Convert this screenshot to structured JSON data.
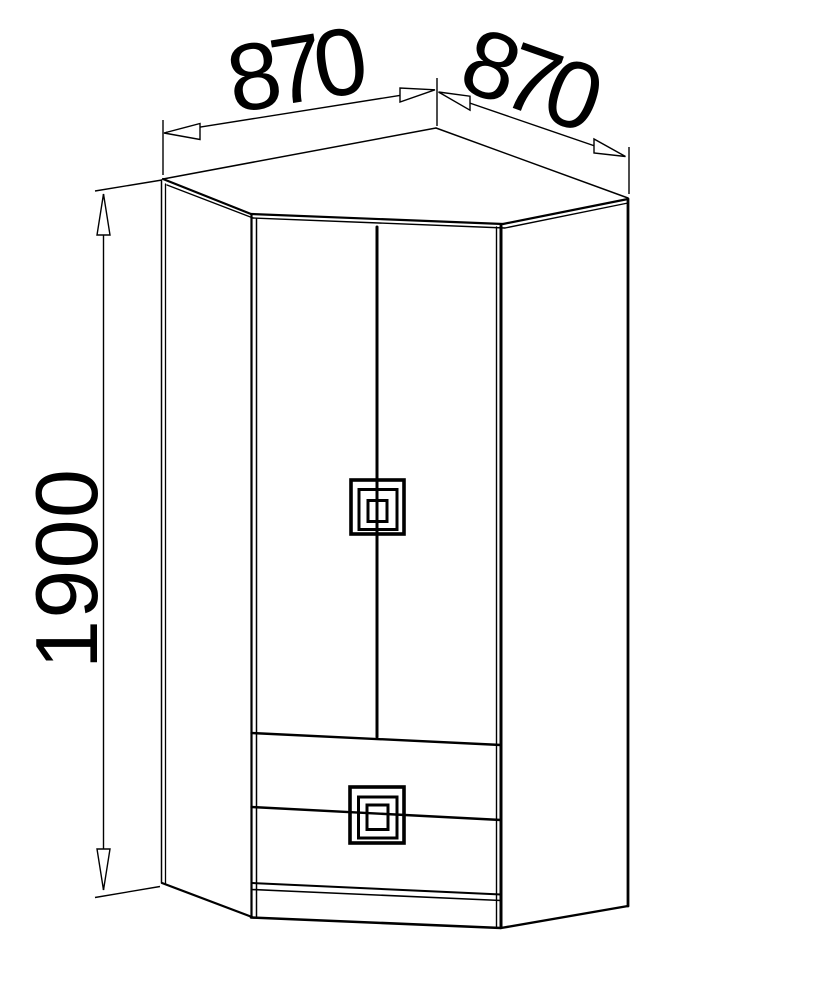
{
  "drawing": {
    "subject": "corner-wardrobe-technical-drawing",
    "background": "#ffffff",
    "line_color": "#000000"
  },
  "dimensions": {
    "top_left_width": "870",
    "top_right_width": "870",
    "height": "1900"
  }
}
